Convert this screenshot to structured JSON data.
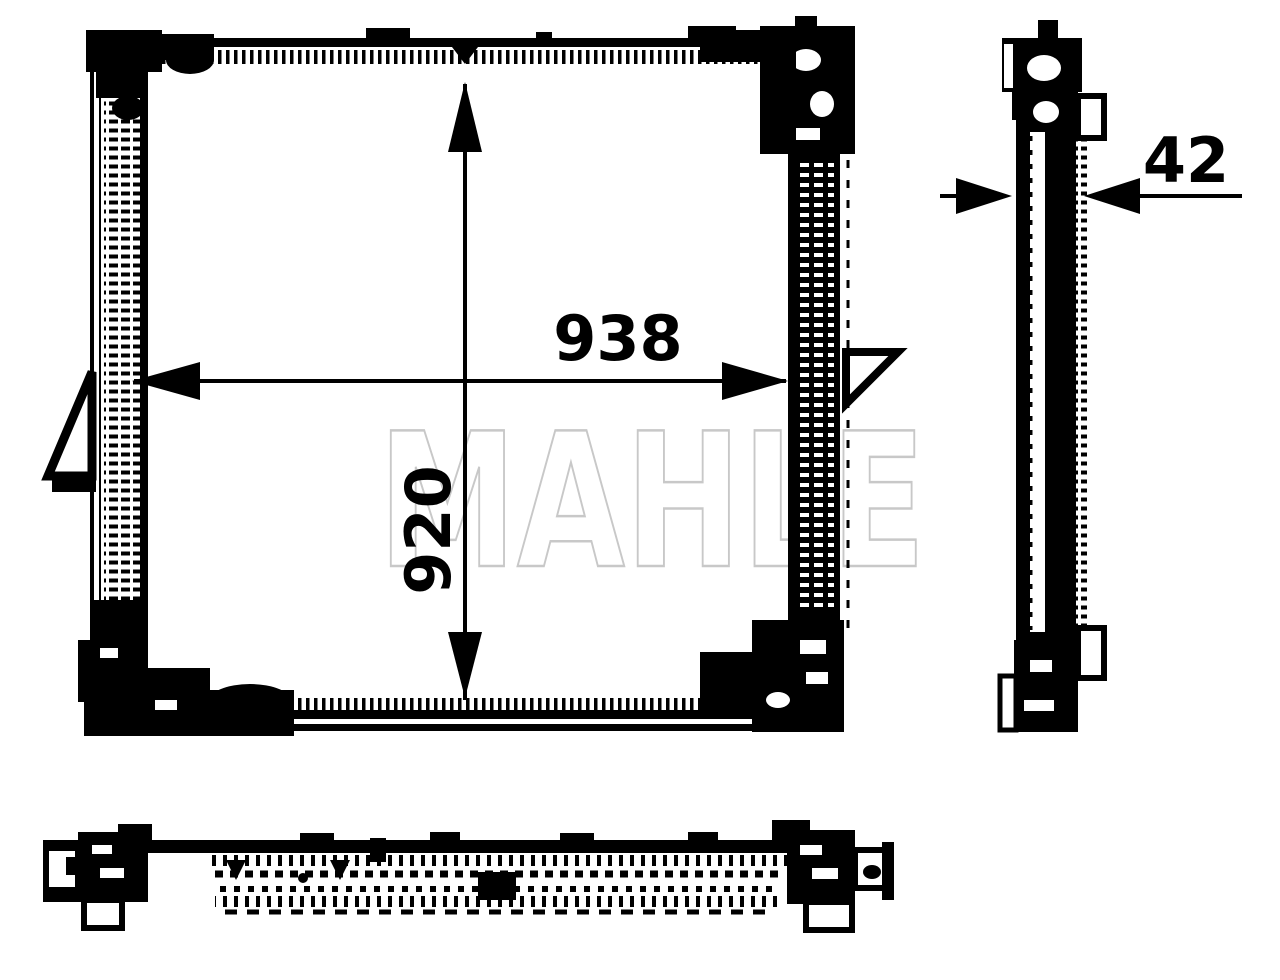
{
  "page": {
    "background_color": "#ffffff"
  },
  "drawing": {
    "ink_color": "#000000",
    "watermark": {
      "text": "MAHLE",
      "outline_color": "#c8c8c8"
    },
    "front_view": {
      "width_label": "938",
      "height_label": "920"
    },
    "side_view": {
      "depth_label": "42"
    }
  }
}
